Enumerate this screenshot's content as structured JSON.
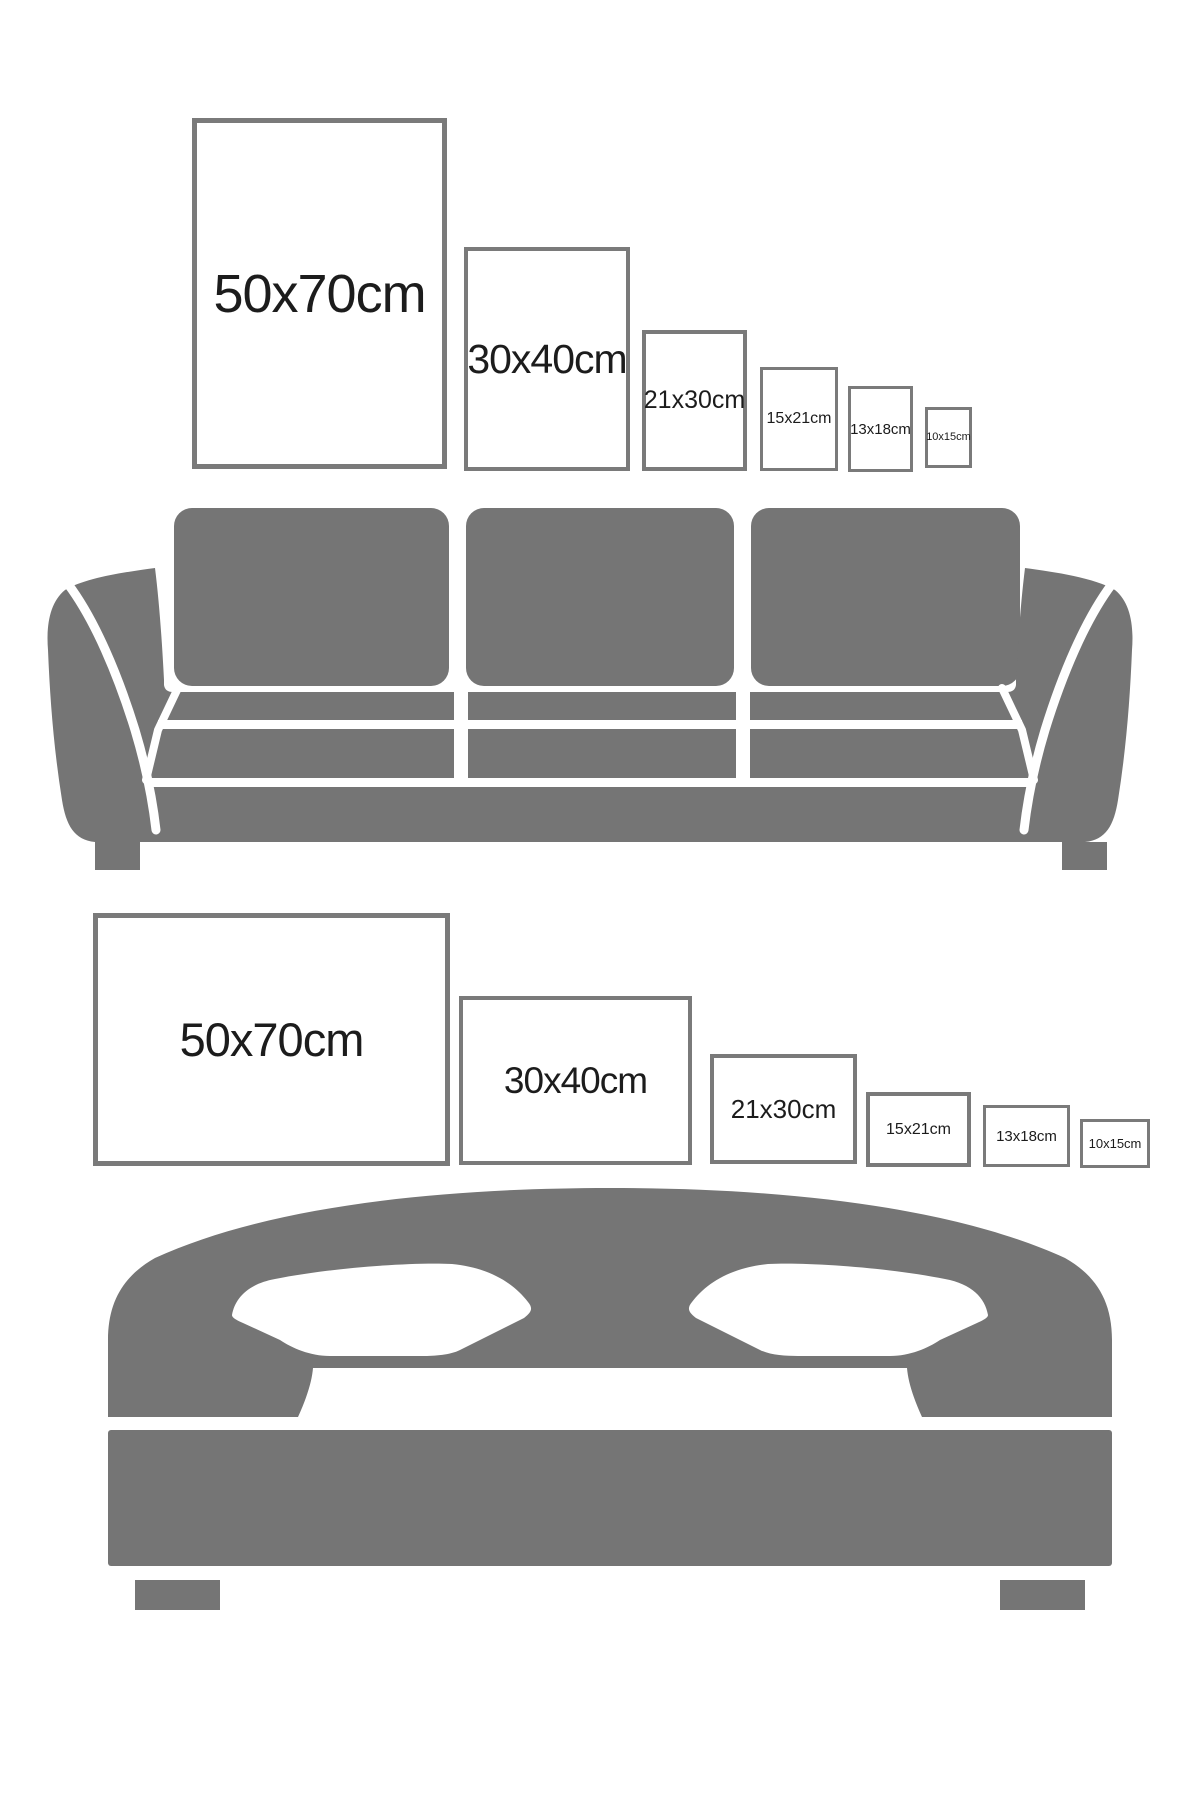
{
  "document": {
    "kind": "poster-size-guide-infographic",
    "background": "#ffffff"
  },
  "colors": {
    "furniture_gray": "#757575",
    "frame_border_gray": "#7a7a7a",
    "label_text": "#1c1c1c"
  },
  "sofa_section": {
    "furniture_icon": "sofa-icon",
    "orientation": "portrait",
    "frames": [
      {
        "size": "50x70",
        "label": "50x70cm"
      },
      {
        "size": "30x40",
        "label": "30x40cm"
      },
      {
        "size": "21x30",
        "label": "21x30cm"
      },
      {
        "size": "15x21",
        "label": "15x21cm"
      },
      {
        "size": "13x18",
        "label": "13x18cm"
      },
      {
        "size": "10x15",
        "label": "10x15cm"
      }
    ]
  },
  "bed_section": {
    "furniture_icon": "bed-icon",
    "orientation": "landscape",
    "frames": [
      {
        "size": "50x70",
        "label": "50x70cm"
      },
      {
        "size": "30x40",
        "label": "30x40cm"
      },
      {
        "size": "21x30",
        "label": "21x30cm"
      },
      {
        "size": "15x21",
        "label": "15x21cm"
      },
      {
        "size": "13x18",
        "label": "13x18cm"
      },
      {
        "size": "10x15",
        "label": "10x15cm"
      }
    ]
  }
}
